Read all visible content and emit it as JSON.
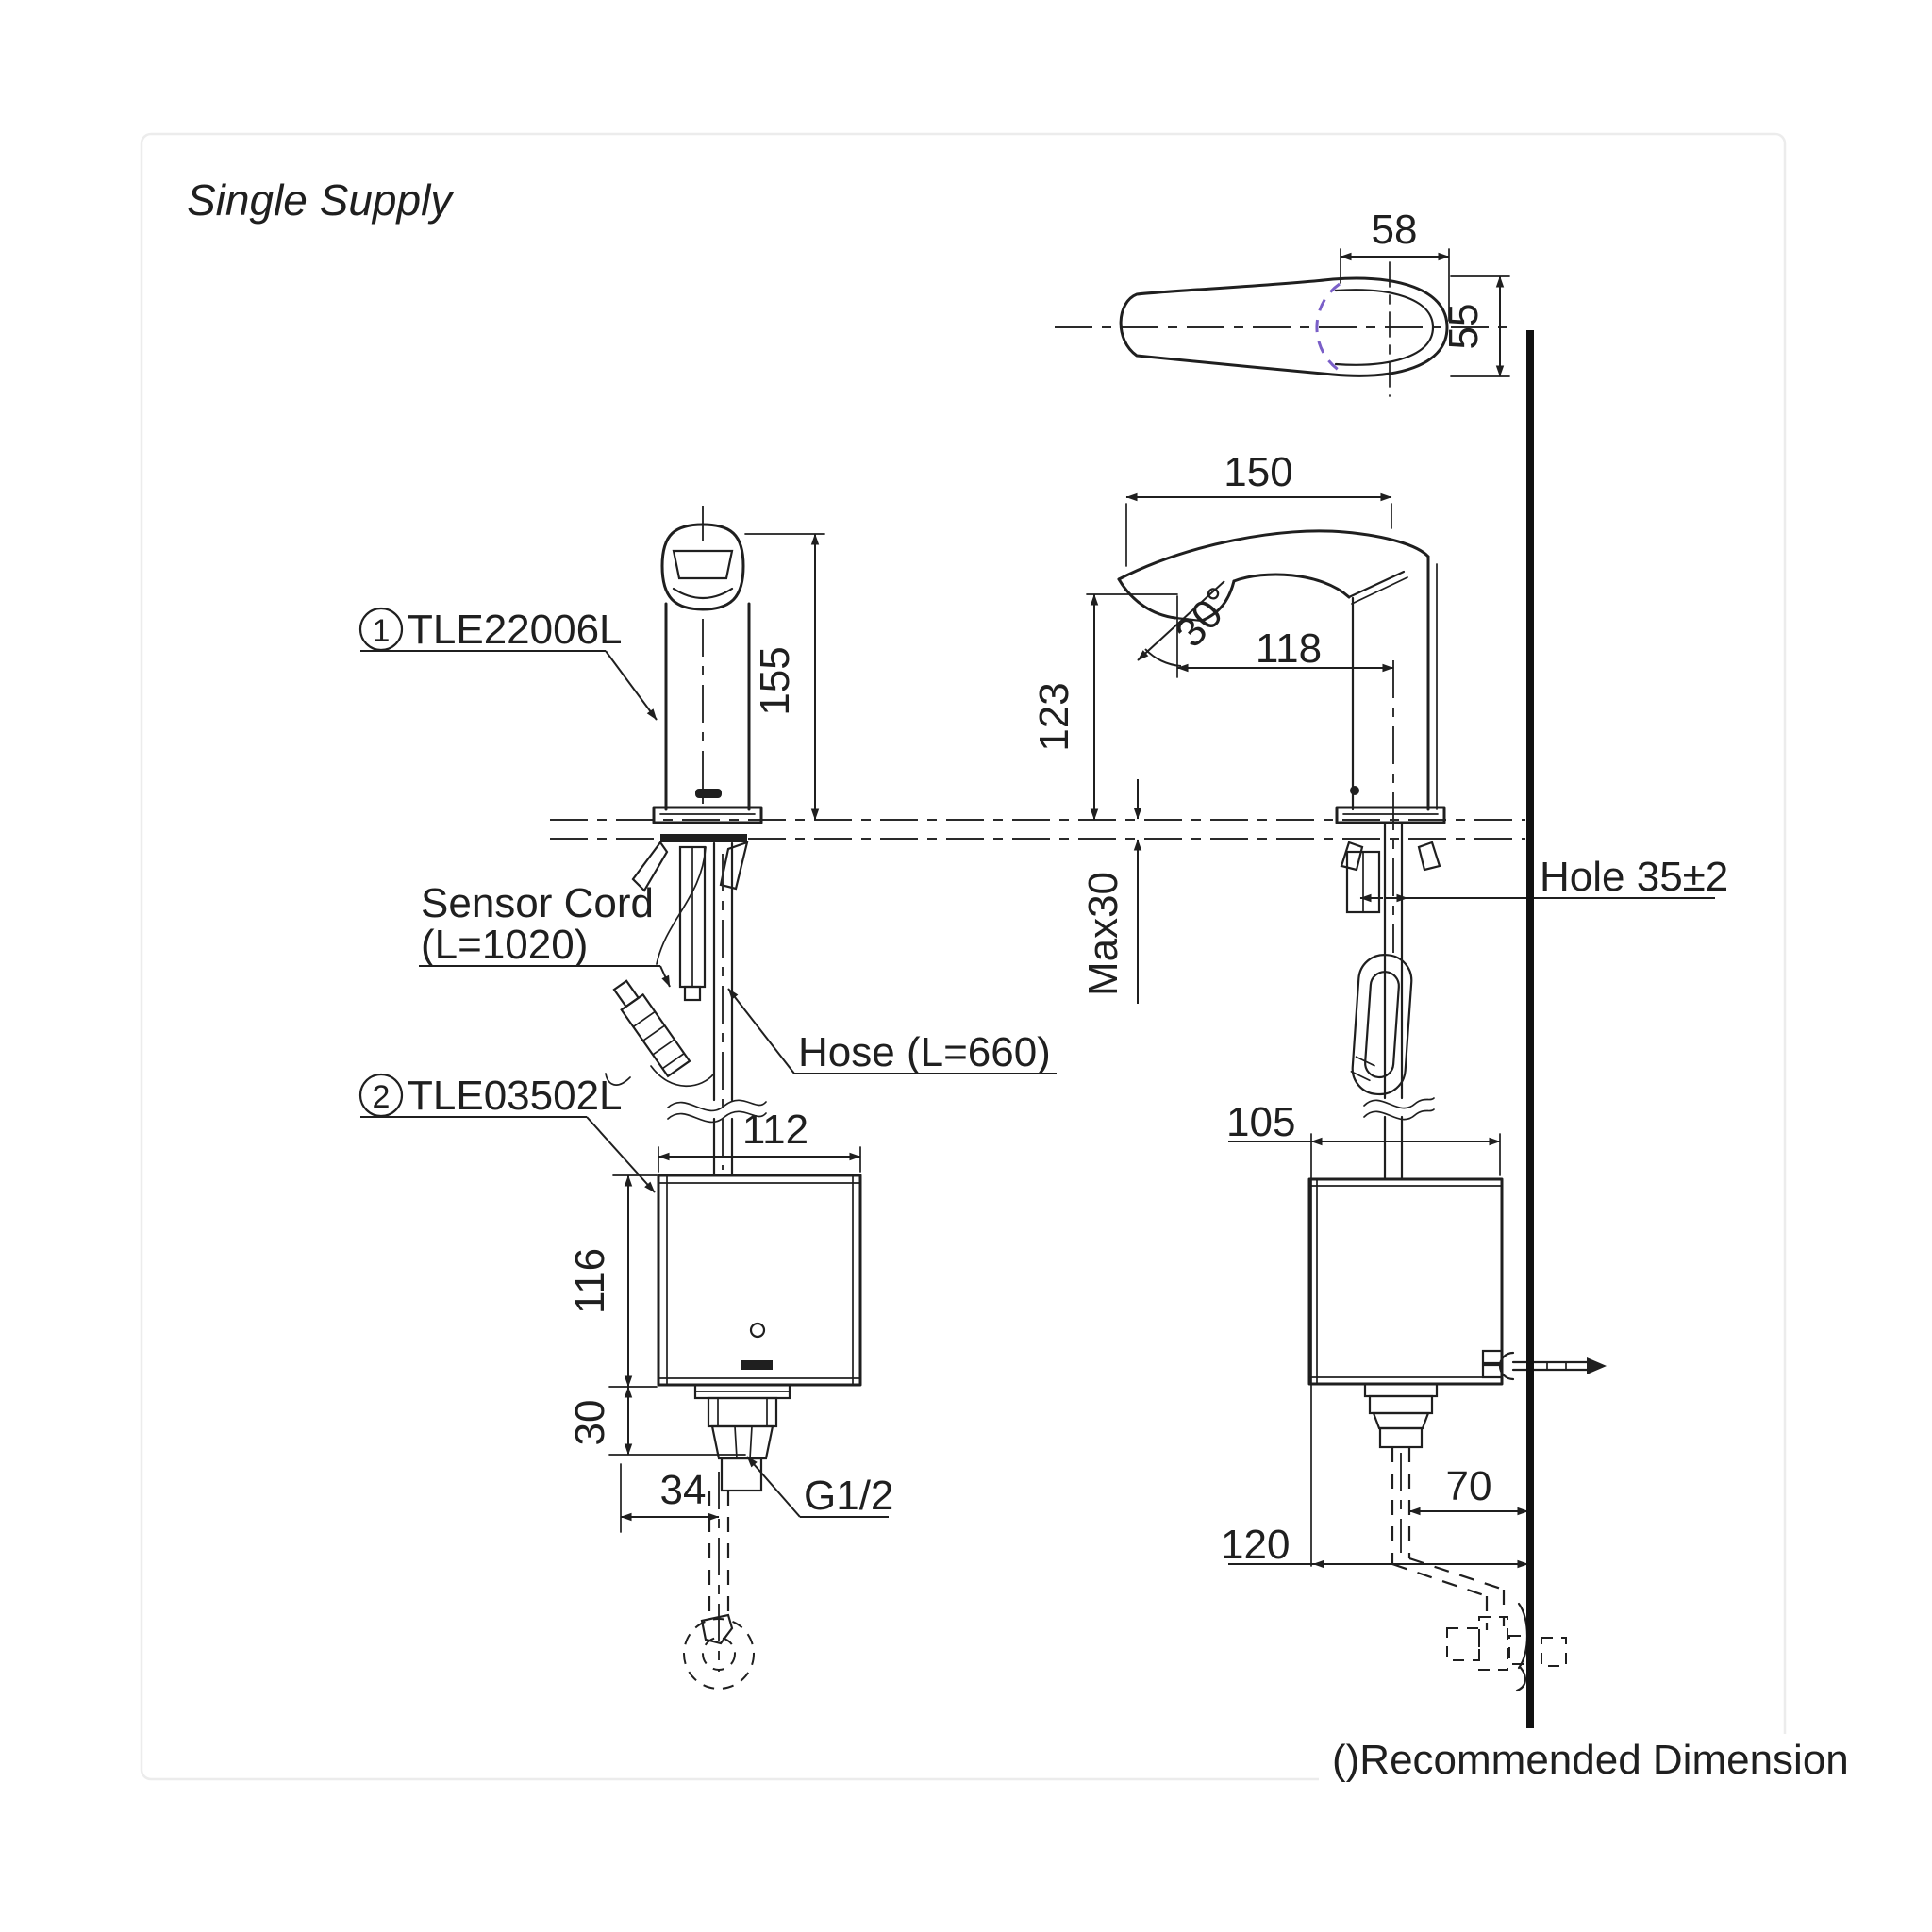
{
  "title": "Single Supply",
  "footnote": "()Recommended Dimension",
  "colors": {
    "line": "#1f1f1f",
    "sensor_arc": "#7a5fc8",
    "wall": "#111111",
    "frame": "#ececec",
    "background": "#ffffff"
  },
  "parts": [
    {
      "index": "1",
      "code": "TLE22006L"
    },
    {
      "index": "2",
      "code": "TLE03502L"
    }
  ],
  "callouts": {
    "sensor_cord_line1": "Sensor Cord",
    "sensor_cord_line2": "(L=1020)",
    "hose": "Hose (L=660)",
    "thread": "G1/2",
    "hole": "Hole 35±2"
  },
  "dims": {
    "top_view": {
      "handle_width": "58",
      "handle_height": "55"
    },
    "front_view": {
      "spout_height": "155",
      "controller_width": "112",
      "controller_height": "116",
      "outlet_drop": "30",
      "outlet_offset": "34"
    },
    "side_view": {
      "reach": "150",
      "spout_tip_height": "123",
      "outlet_angle": "30°",
      "sensor_reach": "118",
      "deck_thickness": "Max30",
      "controller_width": "105",
      "outlet_to_wall": "70",
      "controller_to_wall": "120"
    }
  }
}
